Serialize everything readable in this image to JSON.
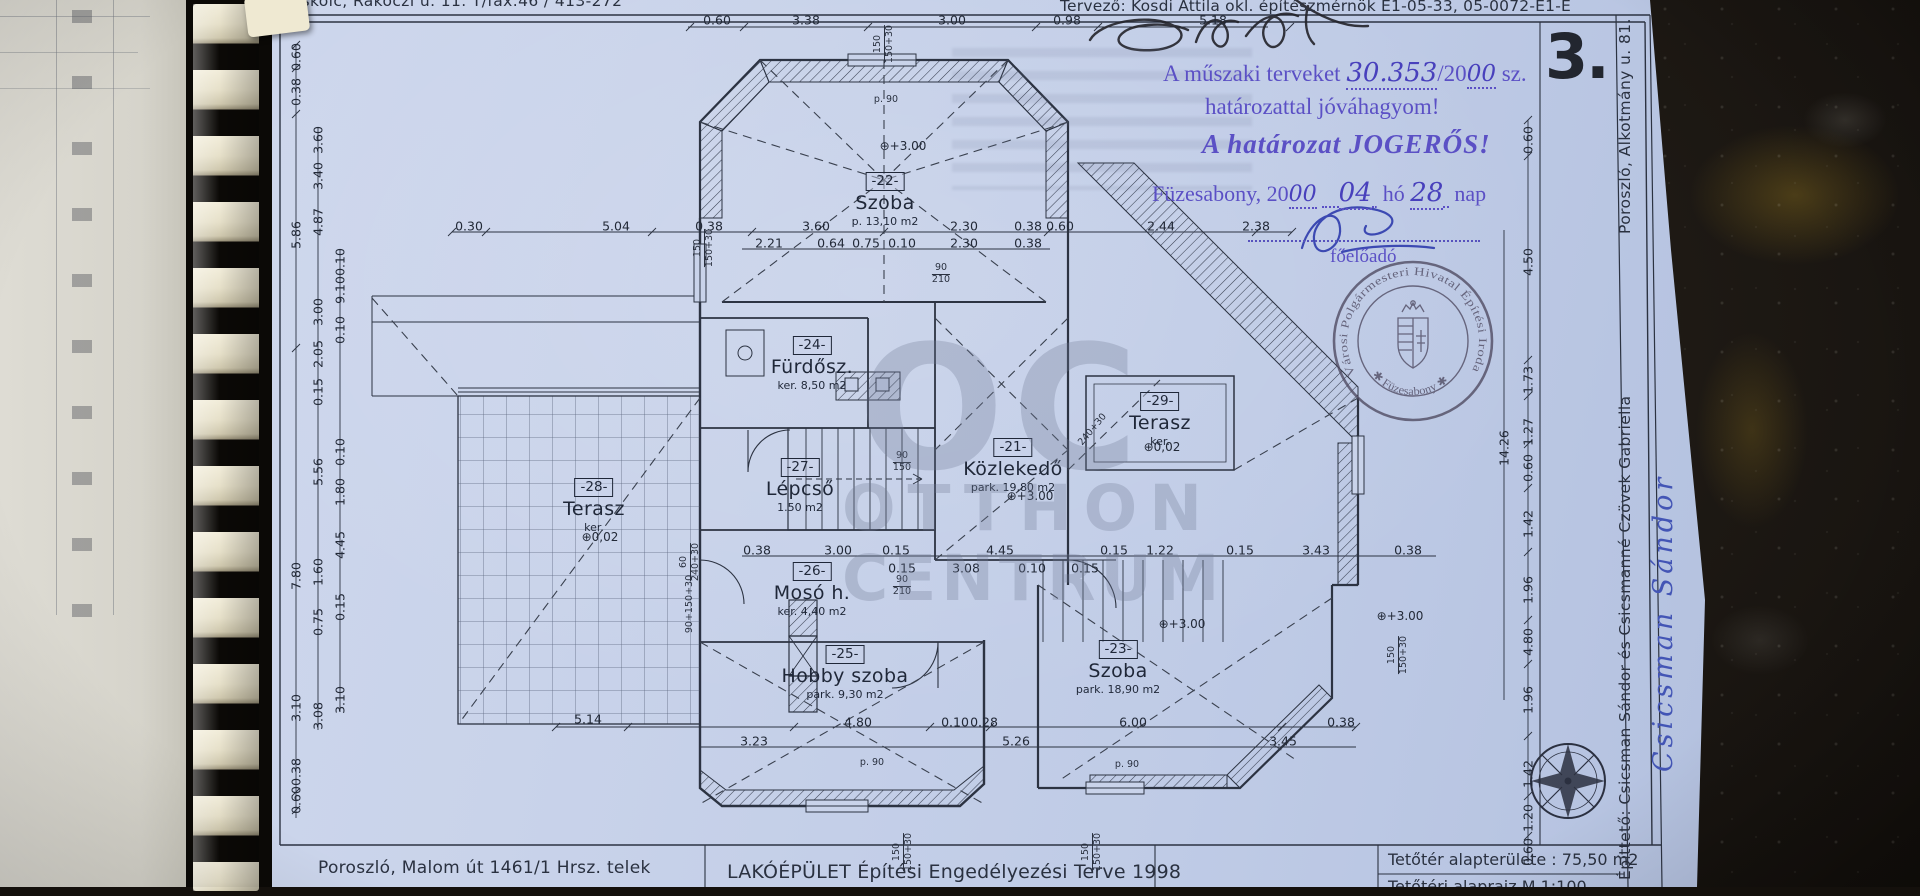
{
  "header": {
    "address_top": "Miskolc, Rákóczi u. 11. T/fax.46 / 413-272",
    "designer": "Tervező: Kosdi Attila okl. építészmérnök E1-05-33, 05-0072-E1-E",
    "sheet_number": "3."
  },
  "approval": {
    "line1_pre": "A műszaki terveket",
    "line1_hand": "30.353",
    "line1_mid": "/20",
    "line1_hand2": "00",
    "line1_post": "sz.",
    "line2": "határozattal jóváhagyom!",
    "line3": "A határozat JOGERŐS!",
    "date_pre": "Füzesabony, 20",
    "date_year": "00",
    "date_month": "04",
    "date_ho": "hó",
    "date_day": "28",
    "date_nap": "nap",
    "role": "főelőadó",
    "ink_color": "#5b50c5"
  },
  "round_stamp": {
    "ring": "Városi Polgármesteri Hivatal Építési Iroda",
    "bottom": "✱ Füzesabony ✱"
  },
  "margin": {
    "owner": "Építtető: Csicsman Sándor és Csicsmanné Czövek Gabriella",
    "owner_address": "Poroszló, Alkotmány u. 81.",
    "handwritten_signature": "Csicsman Sándor"
  },
  "title_block": {
    "site": "Poroszló, Malom út 1461/1 Hrsz. telek",
    "title": "LAKÓÉPÜLET Építési Engedélyezési Terve  1998",
    "area": "Tetőtér alapterülete : 75,50 m2",
    "scale": "Tetőtéri alaprajz      M 1:100"
  },
  "watermark": {
    "l1": "OC",
    "l2": "OTTHON",
    "l3": "CENTRUM"
  },
  "rooms": [
    {
      "num": "-22-",
      "name": "Szoba",
      "info": "p. 13,10 m2",
      "x": 885,
      "y": 170
    },
    {
      "num": "-24-",
      "name": "Fürdősz.",
      "info": "ker. 8,50 m2",
      "x": 812,
      "y": 334
    },
    {
      "num": "-27-",
      "name": "Lépcső",
      "info": "1.50 m2",
      "x": 800,
      "y": 456
    },
    {
      "num": "-21-",
      "name": "Közlekedő",
      "info": "park. 19,80 m2",
      "x": 1013,
      "y": 436
    },
    {
      "num": "-29-",
      "name": "Terasz",
      "info": "ker.",
      "x": 1160,
      "y": 390
    },
    {
      "num": "-28-",
      "name": "Terasz",
      "info": "ker.",
      "x": 594,
      "y": 476
    },
    {
      "num": "-26-",
      "name": "Mosó h.",
      "info": "ker. 4,40 m2",
      "x": 812,
      "y": 560
    },
    {
      "num": "-25-",
      "name": "Hobby szoba",
      "info": "park. 9,30 m2",
      "x": 845,
      "y": 643
    },
    {
      "num": "-23-",
      "name": "Szoba",
      "info": "park. 18,90 m2",
      "x": 1118,
      "y": 638
    }
  ],
  "levels": [
    {
      "t": "+3.00",
      "x": 903,
      "y": 146
    },
    {
      "t": "+3.00",
      "x": 1030,
      "y": 496
    },
    {
      "t": "+3.00",
      "x": 1182,
      "y": 624
    },
    {
      "t": "+3.00",
      "x": 1400,
      "y": 616
    },
    {
      "t": "0,02",
      "x": 600,
      "y": 537
    },
    {
      "t": "0,02",
      "x": 1162,
      "y": 447
    }
  ],
  "dims": {
    "h": [
      {
        "t": "0.60",
        "x": 717,
        "y": 20
      },
      {
        "t": "3.38",
        "x": 806,
        "y": 20
      },
      {
        "t": "3.00",
        "x": 952,
        "y": 20
      },
      {
        "t": "0.98",
        "x": 1067,
        "y": 20
      },
      {
        "t": "5.18",
        "x": 1213,
        "y": 20
      },
      {
        "t": "0.30",
        "x": 469,
        "y": 226
      },
      {
        "t": "5.04",
        "x": 616,
        "y": 226
      },
      {
        "t": "0.38",
        "x": 709,
        "y": 226
      },
      {
        "t": "3.60",
        "x": 816,
        "y": 226
      },
      {
        "t": "2.30",
        "x": 964,
        "y": 226
      },
      {
        "t": "0.38",
        "x": 1028,
        "y": 226
      },
      {
        "t": "0.60",
        "x": 1060,
        "y": 226
      },
      {
        "t": "2.44",
        "x": 1161,
        "y": 226
      },
      {
        "t": "2.38",
        "x": 1256,
        "y": 226
      },
      {
        "t": "2.21",
        "x": 769,
        "y": 243
      },
      {
        "t": "0.64",
        "x": 831,
        "y": 243
      },
      {
        "t": "0.75",
        "x": 866,
        "y": 243
      },
      {
        "t": "0.10",
        "x": 902,
        "y": 243
      },
      {
        "t": "2.30",
        "x": 964,
        "y": 243
      },
      {
        "t": "0.38",
        "x": 1028,
        "y": 243
      },
      {
        "t": "0.38",
        "x": 757,
        "y": 550
      },
      {
        "t": "3.00",
        "x": 838,
        "y": 550
      },
      {
        "t": "0.15",
        "x": 896,
        "y": 550
      },
      {
        "t": "4.45",
        "x": 1000,
        "y": 550
      },
      {
        "t": "0.15",
        "x": 1114,
        "y": 550
      },
      {
        "t": "1.22",
        "x": 1160,
        "y": 550
      },
      {
        "t": "0.15",
        "x": 1240,
        "y": 550
      },
      {
        "t": "3.43",
        "x": 1316,
        "y": 550
      },
      {
        "t": "0.38",
        "x": 1408,
        "y": 550
      },
      {
        "t": "0.15",
        "x": 902,
        "y": 568
      },
      {
        "t": "3.08",
        "x": 966,
        "y": 568
      },
      {
        "t": "0.10",
        "x": 1032,
        "y": 568
      },
      {
        "t": "0.15",
        "x": 1085,
        "y": 568
      },
      {
        "t": "5.14",
        "x": 588,
        "y": 719
      },
      {
        "t": "4.80",
        "x": 858,
        "y": 722
      },
      {
        "t": "0.10",
        "x": 955,
        "y": 722
      },
      {
        "t": "0.28",
        "x": 984,
        "y": 722
      },
      {
        "t": "6.00",
        "x": 1133,
        "y": 722
      },
      {
        "t": "0.38",
        "x": 1341,
        "y": 722
      },
      {
        "t": "3.23",
        "x": 754,
        "y": 741
      },
      {
        "t": "5.26",
        "x": 1016,
        "y": 741
      },
      {
        "t": "3.45",
        "x": 1283,
        "y": 741
      }
    ],
    "v": [
      {
        "t": "0.60",
        "x": 296,
        "y": 57
      },
      {
        "t": "0.38",
        "x": 296,
        "y": 92
      },
      {
        "t": "5.86",
        "x": 296,
        "y": 235
      },
      {
        "t": "7.80",
        "x": 296,
        "y": 576
      },
      {
        "t": "3.10",
        "x": 296,
        "y": 708
      },
      {
        "t": "0.38",
        "x": 296,
        "y": 772
      },
      {
        "t": "0.60",
        "x": 296,
        "y": 800
      },
      {
        "t": "3.60",
        "x": 318,
        "y": 140
      },
      {
        "t": "3.40",
        "x": 318,
        "y": 176
      },
      {
        "t": "4.87",
        "x": 318,
        "y": 222
      },
      {
        "t": "3.00",
        "x": 318,
        "y": 312
      },
      {
        "t": "2.05",
        "x": 318,
        "y": 354
      },
      {
        "t": "0.15",
        "x": 318,
        "y": 392
      },
      {
        "t": "5.56",
        "x": 318,
        "y": 472
      },
      {
        "t": "1.60",
        "x": 318,
        "y": 572
      },
      {
        "t": "0.75",
        "x": 318,
        "y": 622
      },
      {
        "t": "3.08",
        "x": 318,
        "y": 716
      },
      {
        "t": "0.10",
        "x": 340,
        "y": 262
      },
      {
        "t": "9.10",
        "x": 340,
        "y": 290
      },
      {
        "t": "0.10",
        "x": 340,
        "y": 330
      },
      {
        "t": "0.10",
        "x": 340,
        "y": 452
      },
      {
        "t": "1.80",
        "x": 340,
        "y": 492
      },
      {
        "t": "4.45",
        "x": 340,
        "y": 545
      },
      {
        "t": "0.15",
        "x": 340,
        "y": 607
      },
      {
        "t": "3.10",
        "x": 340,
        "y": 700
      },
      {
        "t": "0.60",
        "x": 1528,
        "y": 140
      },
      {
        "t": "4.50",
        "x": 1528,
        "y": 262
      },
      {
        "t": "1.73",
        "x": 1528,
        "y": 380
      },
      {
        "t": "1.27",
        "x": 1528,
        "y": 432
      },
      {
        "t": "0.60",
        "x": 1528,
        "y": 468
      },
      {
        "t": "1.42",
        "x": 1528,
        "y": 524
      },
      {
        "t": "1.96",
        "x": 1528,
        "y": 590
      },
      {
        "t": "4.80",
        "x": 1528,
        "y": 642
      },
      {
        "t": "1.96",
        "x": 1528,
        "y": 700
      },
      {
        "t": "1.42",
        "x": 1528,
        "y": 774
      },
      {
        "t": "1.20",
        "x": 1528,
        "y": 818
      },
      {
        "t": "0.60",
        "x": 1528,
        "y": 852
      },
      {
        "t": "14.26",
        "x": 1504,
        "y": 448
      }
    ]
  },
  "plan_labels": [
    {
      "l": [
        "150",
        "150+30"
      ],
      "x": 884,
      "y": 44,
      "r": -90
    },
    {
      "l": [
        "p. 90"
      ],
      "x": 886,
      "y": 100,
      "r": 0
    },
    {
      "l": [
        "150",
        "150+30"
      ],
      "x": 704,
      "y": 248,
      "r": -90
    },
    {
      "l": [
        "90",
        "210"
      ],
      "x": 941,
      "y": 274,
      "r": 0
    },
    {
      "l": [
        "90",
        "150"
      ],
      "x": 902,
      "y": 462,
      "r": 0
    },
    {
      "l": [
        "90",
        "210"
      ],
      "x": 902,
      "y": 586,
      "r": 0
    },
    {
      "l": [
        "240+30"
      ],
      "x": 1093,
      "y": 430,
      "r": -50
    },
    {
      "l": [
        "60",
        "240+30"
      ],
      "x": 690,
      "y": 562,
      "r": -90
    },
    {
      "l": [
        "90+150+30"
      ],
      "x": 690,
      "y": 604,
      "r": -90
    },
    {
      "l": [
        "150",
        "150+30"
      ],
      "x": 1398,
      "y": 655,
      "r": -90
    },
    {
      "l": [
        "150",
        "150+30"
      ],
      "x": 903,
      "y": 852,
      "r": -90
    },
    {
      "l": [
        "150",
        "150+30"
      ],
      "x": 1092,
      "y": 852,
      "r": -90
    },
    {
      "l": [
        "p. 90"
      ],
      "x": 872,
      "y": 763,
      "r": 0
    },
    {
      "l": [
        "p. 90"
      ],
      "x": 1127,
      "y": 765,
      "r": 0
    }
  ]
}
